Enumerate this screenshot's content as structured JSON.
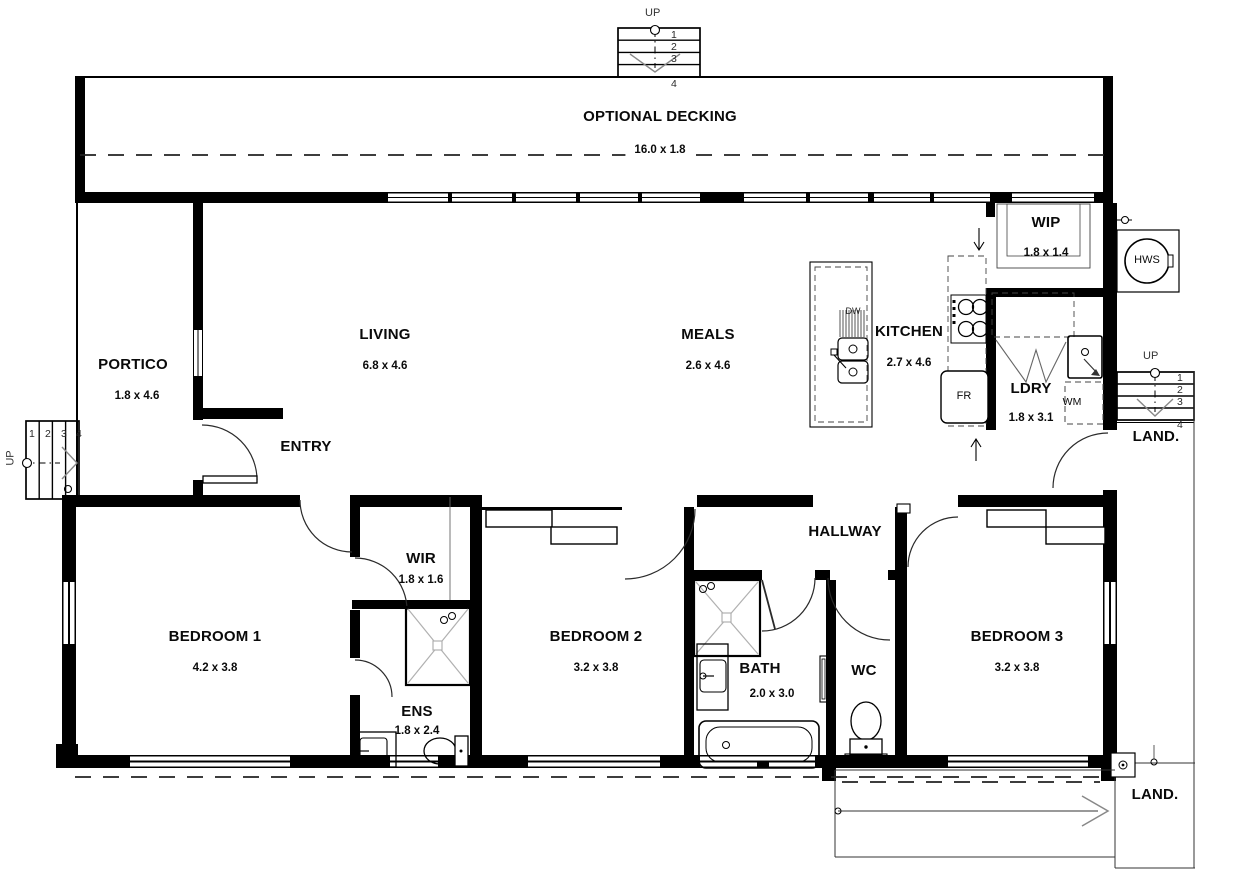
{
  "deck": {
    "label": "OPTIONAL DECKING",
    "dims": "16.0 x 1.8"
  },
  "rooms": {
    "portico": {
      "label": "PORTICO",
      "dims": "1.8 x 4.6"
    },
    "living": {
      "label": "LIVING",
      "dims": "6.8 x 4.6"
    },
    "meals": {
      "label": "MEALS",
      "dims": "2.6 x 4.6"
    },
    "kitchen": {
      "label": "KITCHEN",
      "dims": "2.7 x 4.6"
    },
    "wip": {
      "label": "WIP",
      "dims": "1.8 x 1.4"
    },
    "ldry": {
      "label": "LDRY",
      "dims": "1.8 x 3.1"
    },
    "entry": {
      "label": "ENTRY"
    },
    "hallway": {
      "label": "HALLWAY"
    },
    "wir": {
      "label": "WIR",
      "dims": "1.8 x 1.6"
    },
    "bedroom1": {
      "label": "BEDROOM 1",
      "dims": "4.2 x 3.8"
    },
    "bedroom2": {
      "label": "BEDROOM 2",
      "dims": "3.2 x 3.8"
    },
    "bedroom3": {
      "label": "BEDROOM 3",
      "dims": "3.2 x 3.8"
    },
    "bath": {
      "label": "BATH",
      "dims": "2.0 x 3.0"
    },
    "wc": {
      "label": "WC"
    },
    "ens": {
      "label": "ENS",
      "dims": "1.8 x 2.4"
    }
  },
  "fixtures": {
    "hws": "HWS",
    "fridge": "FR",
    "dishwasher": "DW",
    "washing_machine": "WM"
  },
  "stairs": {
    "up": "UP",
    "steps": [
      "1",
      "2",
      "3",
      "4"
    ]
  },
  "landing": {
    "label": "LAND."
  },
  "colors": {
    "wall": "#000000",
    "line": "#333333",
    "text": "#0a0a0a",
    "shower_line": "#b0b0b0"
  }
}
